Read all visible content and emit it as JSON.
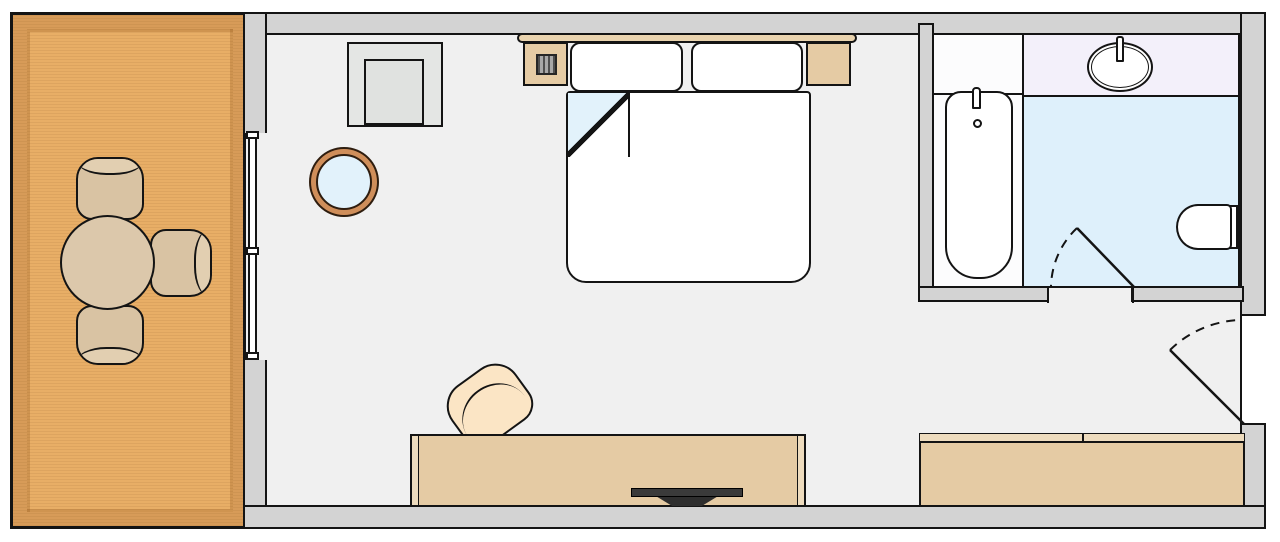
{
  "diagram": {
    "type": "floor-plan",
    "subject": "hotel guest room with balcony, bedroom and bathroom (top-down plan, no text labels)",
    "rooms": [
      {
        "name": "balcony",
        "floor_material": "wood deck",
        "furniture": [
          "round dining table",
          "patio chair (top)",
          "patio chair (right)",
          "patio chair (bottom)"
        ]
      },
      {
        "name": "bedroom",
        "floor_material": "light gray carpet",
        "furniture": [
          "headboard",
          "double bed with folded-back sheet",
          "pillow (left)",
          "pillow (right)",
          "nightstand (left) with telephone",
          "nightstand (right)",
          "square armchair",
          "round glass side table",
          "desk / TV console",
          "flat-screen television",
          "desk chair"
        ]
      },
      {
        "name": "bathroom",
        "floor_material": "light blue tile",
        "furniture": [
          "bathtub with faucet and drain",
          "shelf ledge",
          "vanity counter",
          "oval sink with faucet",
          "toilet"
        ]
      },
      {
        "name": "entry-corridor",
        "floor_material": "light gray carpet",
        "furniture": [
          "wardrobe closet with divided top rail"
        ]
      }
    ],
    "openings": [
      {
        "name": "sliding-balcony-window",
        "between": [
          "balcony",
          "bedroom"
        ],
        "type": "sliding glass"
      },
      {
        "name": "bathroom-door",
        "between": [
          "entry-corridor",
          "bathroom"
        ],
        "type": "swing door, opens into bathroom, dashed swing arc"
      },
      {
        "name": "entry-door",
        "between": [
          "outside",
          "entry-corridor"
        ],
        "type": "swing door, opens into room, dashed swing arc"
      }
    ],
    "counts": {
      "patio_chairs": 3,
      "pillows": 2,
      "nightstands": 2,
      "doors": 2,
      "windows": 1
    }
  },
  "palette": {
    "line": "#141414",
    "wall": "#d3d3d3",
    "floor": "#f0f0f0",
    "wood-dark": "#d79b58",
    "wood-light": "#e8ae66",
    "tan": "#e5cba4",
    "headboard": "#e9d3ae",
    "bath-floor": "#def0fb",
    "vanity": "#f3f0fa",
    "glass-blue": "#e2f2fb",
    "seat-cream": "#fbe5c5",
    "chair-tan": "#d9c3a3",
    "chair-band": "#e2cfb1",
    "table-top": "#dcc8ab",
    "armchair": "#e4e6e4",
    "tv": "#3a3a3a"
  }
}
